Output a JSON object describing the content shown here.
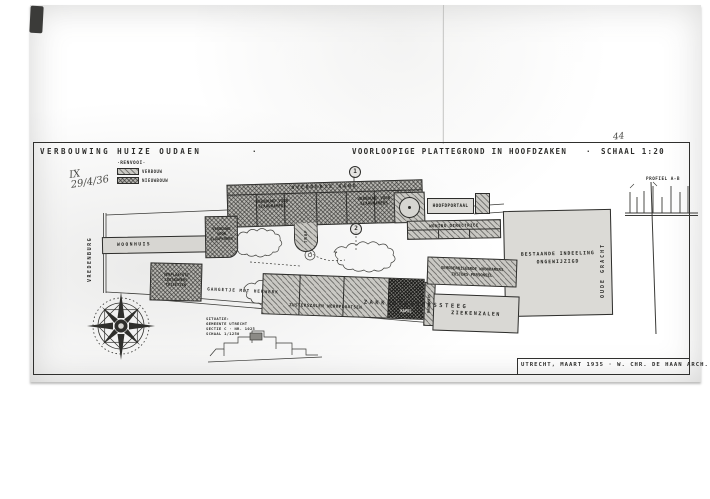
{
  "document": {
    "title_left": "VERBOUWING HUIZE OUDAEN",
    "title_mid": "VOORLOOPIGE PLATTEGROND IN HOOFDZAKEN",
    "title_scale": "SCHAAL 1:20",
    "sep": "·",
    "hw1": "IX",
    "hw2": "29/4/36",
    "sheet_no": "44",
    "signature": "UTRECHT, MAART 1935 · W. CHR. DE HAAN ARCH."
  },
  "legend": {
    "heading": "·RENVOOI·",
    "items": [
      {
        "label": "VERBOUW"
      },
      {
        "label": "NIEUWBOUW"
      }
    ]
  },
  "streets": {
    "left_vertical": "VREDENBURG",
    "right_vertical": "OUDE GRACHT",
    "alley": "GANGETJE MET HEKWERK",
    "bottom": "ZAKKENDRAGERSSTEEG"
  },
  "plan": {
    "gang": {
      "label": "OVERDEKTE GANG"
    },
    "slaap_west": {
      "line1": "VERBOUWD VOOR",
      "line2": "SLAAPKAMERS"
    },
    "slaap_oost": {
      "line1": "VERBOUWD VOOR",
      "line2": "SLAAPKAMERS"
    },
    "trap": {
      "label": "TRAP"
    },
    "hoofdportaal": {
      "label": "HOOFDPORTAAL"
    },
    "directrice": {
      "label": "WONING DIRECTRICE"
    },
    "woonhuis": {
      "label": "WOONHUIS"
    },
    "verbouw": {
      "line1": "VERBOUWD",
      "line2": "VOOR",
      "line3": "SLAAPKAMER"
    },
    "verplaatst": {
      "line1": "VERPLAATSTE",
      "line2": "LEESKAMERS",
      "line3": "TOILETTEN"
    },
    "bestaand": {
      "line1": "BESTAANDE INDEELING",
      "line2": "ONGEWIJZIGD"
    },
    "woonkamers": {
      "line1": "GEMODERNISEERDE WOONKAMERS",
      "line2": "ZUSTERS PERSONEEL"
    },
    "zusterszalen": {
      "label": "ZUSTERSZALEN WERKPLAATSEN"
    },
    "kapel": {
      "label": "KAPEL"
    },
    "badkamers": {
      "label": "BADKAMERS"
    },
    "ziekenzalen": {
      "label": "ZIEKENZALEN"
    }
  },
  "profile": {
    "label": "PROFIEL A-B"
  },
  "markers": {
    "one": "1",
    "two": "2"
  },
  "situatie": {
    "line1": "SITUATIE:",
    "line2": "GEMEENTE UTRECHT",
    "line3": "SECTIE C · NR. 1025",
    "line4": "SCHAAL 1/1250"
  },
  "colors": {
    "paper": "#d6d5d1",
    "ink": "#2d2d2b"
  }
}
